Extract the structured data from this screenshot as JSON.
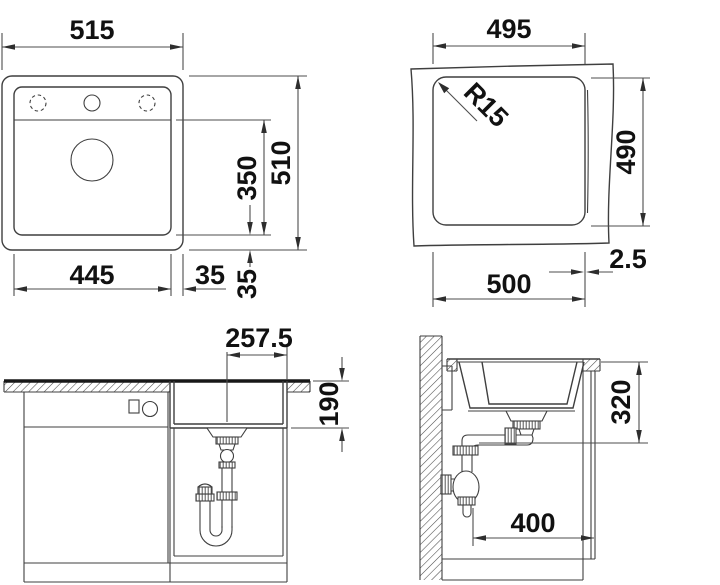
{
  "drawing": {
    "kind": "sink-installation-technical-drawing",
    "views": {
      "top": {
        "dims": {
          "overall_width": "515",
          "overall_depth": "510",
          "bowl_depth": "350",
          "bowl_width": "445",
          "rim_right": "35",
          "rim_bottom": "35"
        }
      },
      "cutout": {
        "dims": {
          "width": "495",
          "depth": "490",
          "corner_radius": "R15",
          "width_bottom": "500",
          "reveal": "2.5"
        }
      },
      "front": {
        "dims": {
          "drain_offset": "257.5",
          "bowl_height": "190"
        }
      },
      "side": {
        "dims": {
          "trap_height": "320",
          "clearance": "400"
        }
      }
    },
    "colors": {
      "line": "#3f3f3f",
      "dim": "#4d4d4d",
      "text": "#111111",
      "bg": "#ffffff"
    }
  }
}
